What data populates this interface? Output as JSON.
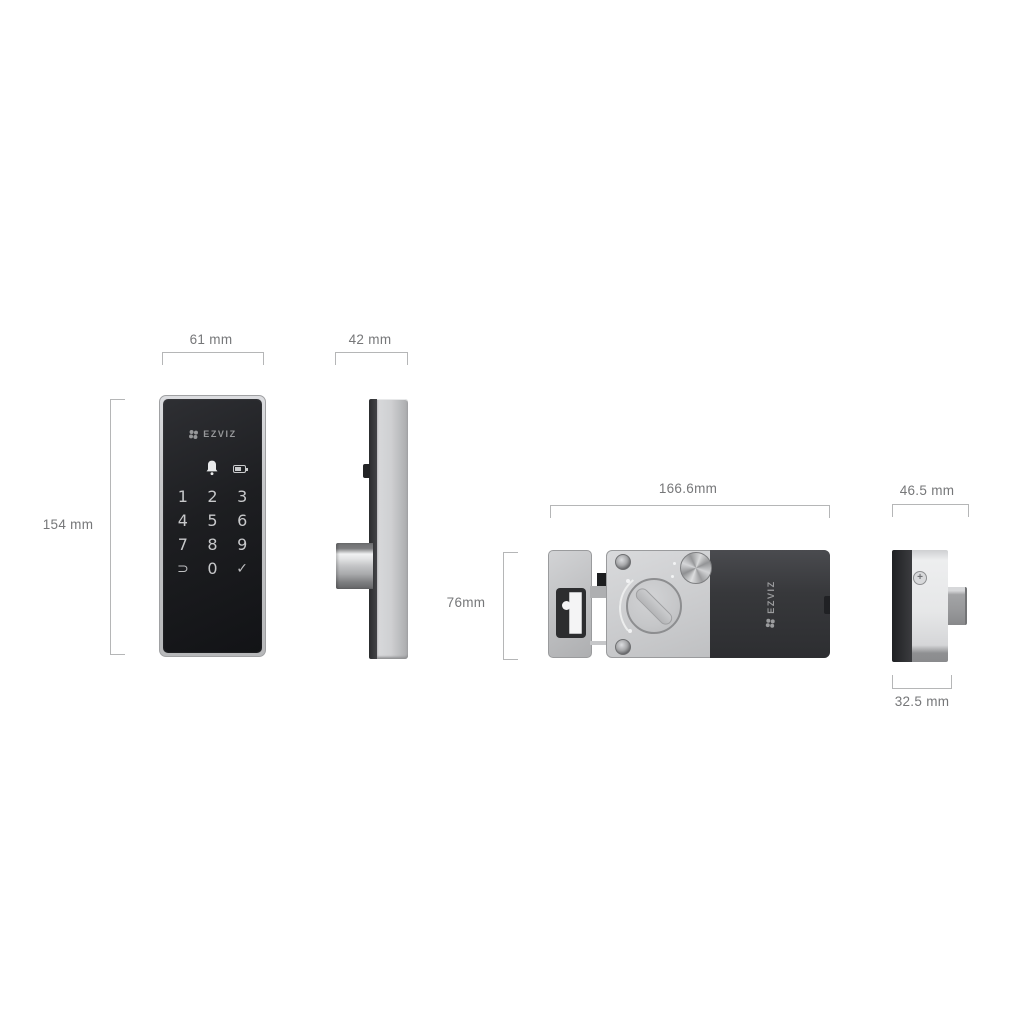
{
  "brand": "EZVIZ",
  "diagram": "smart door lock dimension drawing",
  "views": {
    "keypad_front": {
      "name": "keypad front view",
      "width_label": "61 mm",
      "height_label": "154 mm",
      "logo": "EZVIZ",
      "status_icons": [
        "doorbell-icon",
        "battery-icon"
      ],
      "keys": [
        "1",
        "2",
        "3",
        "4",
        "5",
        "6",
        "7",
        "8",
        "9",
        "⊃",
        "0",
        "✓"
      ]
    },
    "keypad_side": {
      "name": "keypad side view",
      "depth_label": "42 mm"
    },
    "lock_rear": {
      "name": "rear lock unit view",
      "width_label": "166.6mm",
      "height_label": "76mm",
      "logo": "EZVIZ"
    },
    "lock_rear_side": {
      "name": "rear lock unit side view",
      "width_label": "46.5 mm",
      "depth_label": "32.5 mm"
    }
  },
  "colors": {
    "background": "#ffffff",
    "dimension_line": "#b5b6b7",
    "dimension_text": "#767779",
    "silver": "#c6c7c9",
    "keypad_black": "#1d1e21",
    "battery_cover_dark": "#35363a"
  }
}
